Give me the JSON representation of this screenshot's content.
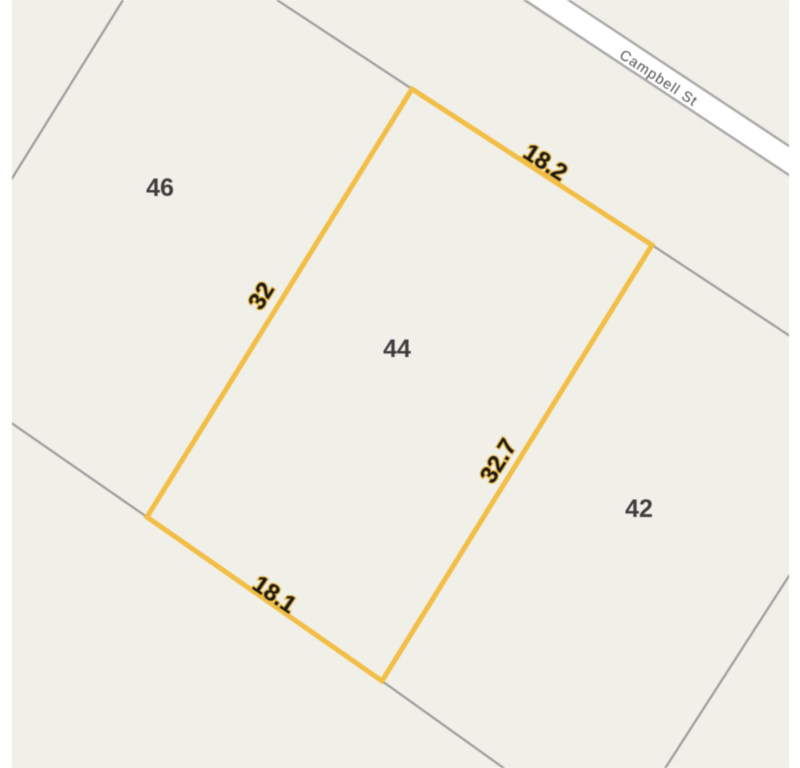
{
  "map": {
    "street": {
      "name": "Campbell St"
    },
    "neighbor_parcels": [
      {
        "label": "46"
      },
      {
        "label": "42"
      }
    ],
    "selected_parcel": {
      "lot_label": "44",
      "dimensions": [
        {
          "side": "northeast-street-frontage",
          "value": "18.2"
        },
        {
          "side": "northwest",
          "value": "32"
        },
        {
          "side": "southeast",
          "value": "32.7"
        },
        {
          "side": "southwest",
          "value": "18.1"
        }
      ]
    },
    "colors": {
      "map_background": "#F0EFE8",
      "page_margin": "#FFFFFF",
      "parcel_boundary": "#9C9C9C",
      "road_fill": "#FFFFFF",
      "road_casing": "#A8A8A8",
      "selected_outline": "#F2BE45",
      "lot_number_text": "#3E3E3E",
      "dimension_text": "#1A1A1A",
      "dimension_halo": "#E9B63C",
      "street_text": "#4F4F4F"
    }
  }
}
